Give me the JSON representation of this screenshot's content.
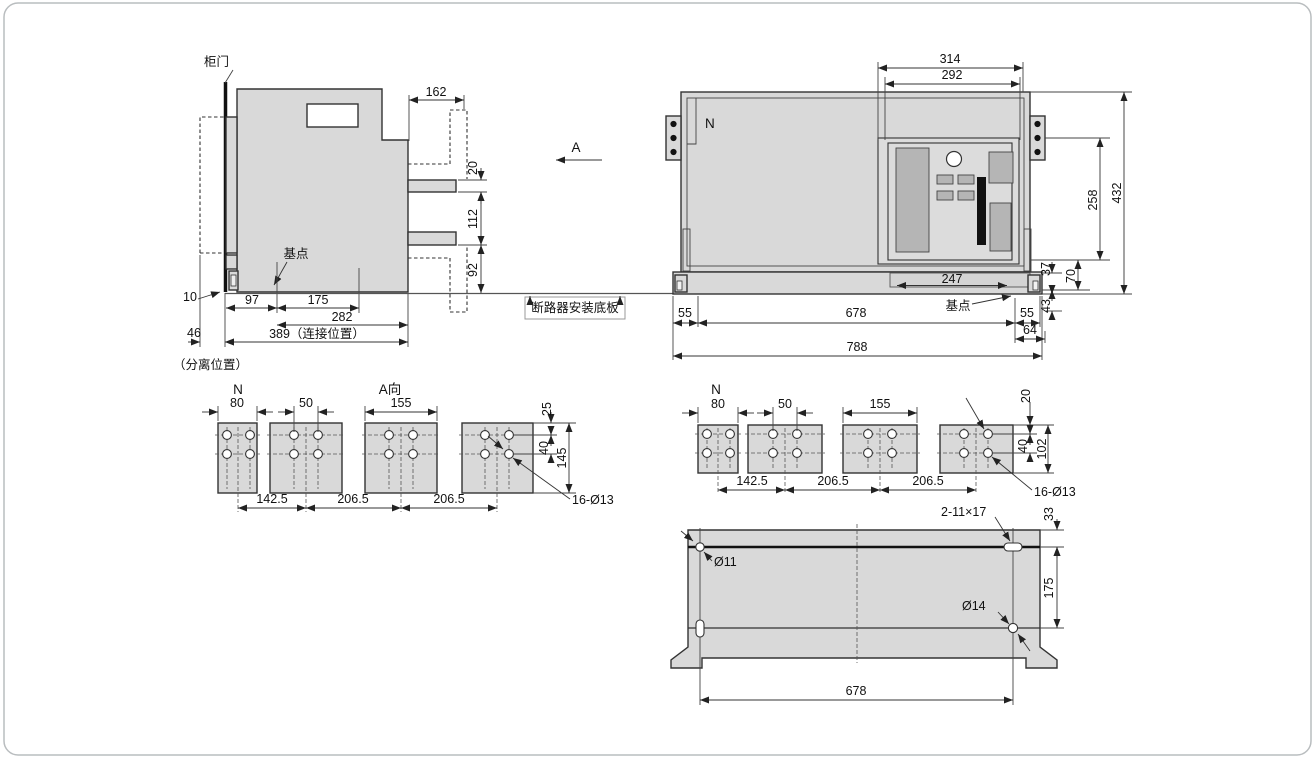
{
  "colors": {
    "body_fill": "#d9d9d9",
    "line": "#333333",
    "dark": "#111111",
    "panel_button": "#b5b5b5"
  },
  "side_view": {
    "door_label": "柜门",
    "base_point_label": "基点",
    "separated_label": "（分离位置）",
    "dim_162": "162",
    "dim_20": "20",
    "dim_112": "112",
    "dim_92": "92",
    "dim_10": "10",
    "dim_97": "97",
    "dim_175": "175",
    "dim_282": "282",
    "dim_46": "46",
    "dim_389": "389（连接位置）"
  },
  "view_arrow_label": "A",
  "baseplate_label": "断路器安装底板",
  "front_view": {
    "phase_label": "N",
    "base_point_label": "基点",
    "dim_314": "314",
    "dim_292": "292",
    "dim_258": "258",
    "dim_432": "432",
    "dim_247": "247",
    "dim_37": "37",
    "dim_70": "70",
    "dim_43": "43",
    "dim_55_left": "55",
    "dim_678": "678",
    "dim_55_right": "55",
    "dim_64": "64",
    "dim_788": "788"
  },
  "terminals_side": {
    "phase_label": "N",
    "view_label": "A向",
    "dim_80": "80",
    "dim_50": "50",
    "dim_155": "155",
    "dim_25": "25",
    "dim_40": "40",
    "dim_145": "145",
    "dim_142_5": "142.5",
    "dim_206_5_a": "206.5",
    "dim_206_5_b": "206.5",
    "holes_label": "16-Ø13"
  },
  "terminals_front": {
    "phase_label": "N",
    "dim_80": "80",
    "dim_50": "50",
    "dim_155": "155",
    "dim_20": "20",
    "dim_40": "40",
    "dim_102": "102",
    "dim_142_5": "142.5",
    "dim_206_5_a": "206.5",
    "dim_206_5_b": "206.5",
    "holes_label": "16-Ø13"
  },
  "mounting_plate": {
    "slot_label": "2-11×17",
    "dim_33": "33",
    "hole_small_label": "Ø11",
    "dim_175": "175",
    "hole_large_label": "Ø14",
    "dim_678": "678"
  }
}
